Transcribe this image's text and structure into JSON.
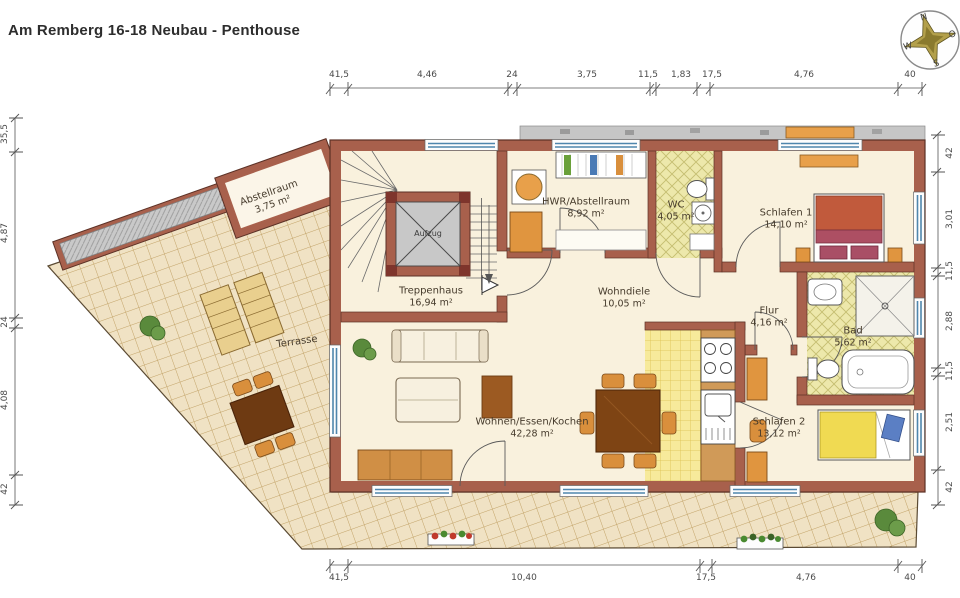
{
  "title": "Am Remberg 16-18 Neubau - Penthouse",
  "compass": {
    "north": "N",
    "east": "O",
    "south": "S",
    "west": "W"
  },
  "rooms": {
    "abstellraum": {
      "name": "Abstellraum",
      "area": "3,75 m²"
    },
    "treppenhaus": {
      "name": "Treppenhaus",
      "area": "16,94 m²"
    },
    "aufzug": {
      "name": "Aufzug"
    },
    "hwr": {
      "name": "HWR/Abstellraum",
      "area": "8,92 m²"
    },
    "wc": {
      "name": "WC",
      "area": "4,05 m²"
    },
    "schlafen1": {
      "name": "Schlafen 1",
      "area": "14,10 m²"
    },
    "wohndiele": {
      "name": "Wohndiele",
      "area": "10,05 m²"
    },
    "flur": {
      "name": "Flur",
      "area": "4,16 m²"
    },
    "bad": {
      "name": "Bad",
      "area": "5,62 m²"
    },
    "schlafen2": {
      "name": "Schlafen 2",
      "area": "13,12 m²"
    },
    "wohnen": {
      "name": "Wohnen/Essen/Kochen",
      "area": "42,28 m²"
    },
    "terrasse": {
      "name": "Terrasse"
    }
  },
  "dimensions": {
    "top": [
      "41,5",
      "4,46",
      "24",
      "3,75",
      "11,5",
      "1,83",
      "17,5",
      "4,76",
      "40"
    ],
    "bottom": [
      "41,5",
      "10,40",
      "17,5",
      "4,76",
      "40"
    ],
    "left": [
      "35,5",
      "4,87",
      "24",
      "4,08",
      "42"
    ],
    "right": [
      "42",
      "3,01",
      "11,5",
      "2,88",
      "11,5",
      "2,51",
      "42"
    ]
  },
  "colors": {
    "wall": "#a8604c",
    "terrace_tile": "#f0e2c4",
    "bath_tile": "#ede8ab",
    "kitchen_tile": "#f7ea9b",
    "furniture_orange": "#e0953f",
    "bed_red": "#c15a3c",
    "bed_yellow": "#f0da52",
    "roof_gray": "#c6c6c6",
    "window_blue": "#4f86ad",
    "plant_green": "#5a8a3c"
  }
}
